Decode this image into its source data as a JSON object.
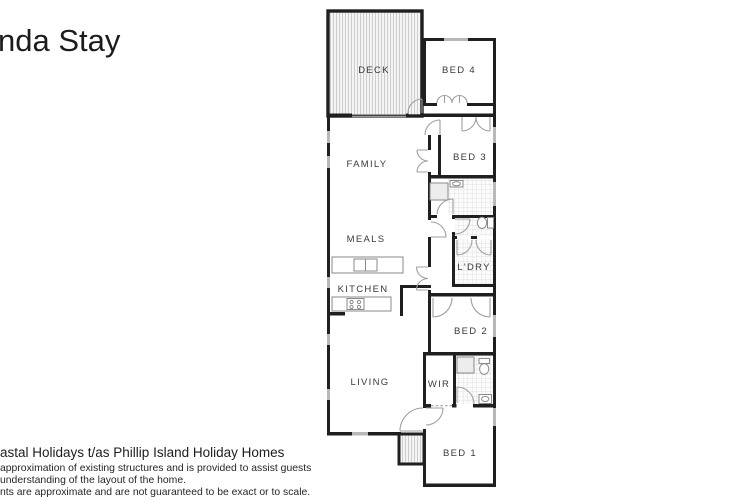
{
  "header": {
    "title": "nda Stay"
  },
  "plan": {
    "colors": {
      "wall": "#1f1f1f",
      "window": "#b8b8b8",
      "door_arc": "#9f9f9f",
      "deck_stripe": "#cdcdcd",
      "tile_grid": "#d9d9d9"
    },
    "rooms": [
      {
        "id": "deck",
        "label": "DECK"
      },
      {
        "id": "bed4",
        "label": "BED 4"
      },
      {
        "id": "family",
        "label": "FAMILY"
      },
      {
        "id": "bed3",
        "label": "BED 3"
      },
      {
        "id": "meals",
        "label": "MEALS"
      },
      {
        "id": "kitchen",
        "label": "KITCHEN"
      },
      {
        "id": "ldry",
        "label": "L'DRY"
      },
      {
        "id": "bed2",
        "label": "BED 2"
      },
      {
        "id": "living",
        "label": "LIVING"
      },
      {
        "id": "wir",
        "label": "WIR"
      },
      {
        "id": "bed1",
        "label": "BED 1"
      }
    ],
    "fixtures": [
      "kitchen-island-sink",
      "cooktop",
      "bathroom-shower",
      "bathroom-vanity",
      "wc-toilet",
      "laundry",
      "ensuite-shower",
      "ensuite-toilet",
      "ensuite-basin"
    ]
  },
  "footer": {
    "company_line": "astal Holidays t/as Phillip Island Holiday Homes",
    "disclaimer_lines": [
      "approximation of existing structures and is provided to assist guests",
      "understanding of the layout of the home.",
      "nts are approximate and are not guaranteed to be exact or to scale."
    ]
  }
}
